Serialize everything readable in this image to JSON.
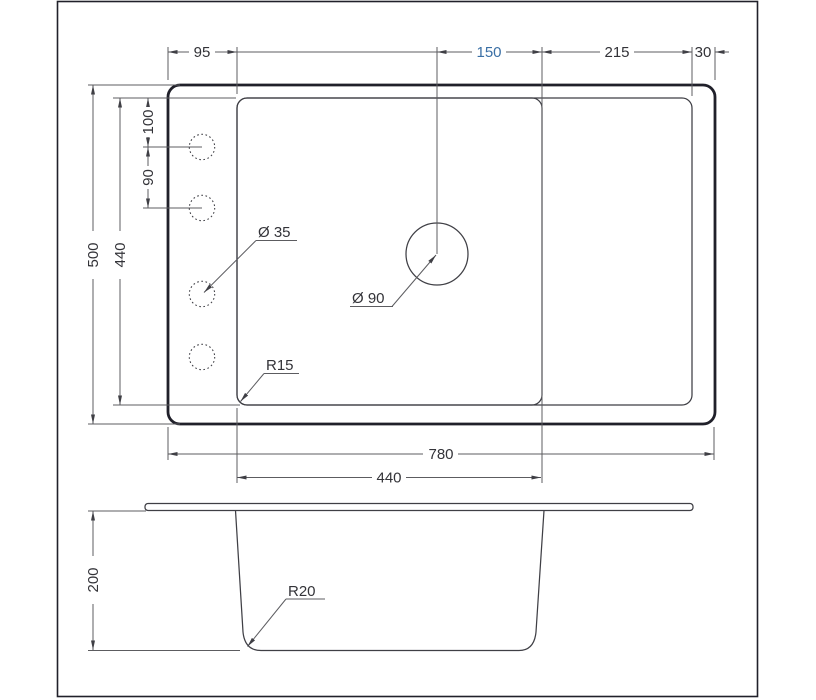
{
  "colors": {
    "background": "#ffffff",
    "line_dark": "#20202a",
    "line": "#3f3f45",
    "dim": "#5c5c60",
    "text": "#333338",
    "accent_blue": "#3a6fa5"
  },
  "dims": {
    "rim_to_bowl_left": "95",
    "drain_to_divider": "150",
    "drainboard_width": "215",
    "right_edge": "30",
    "hole_offset_top": "100",
    "hole_spacing": "90",
    "overall_height": "500",
    "inner_height": "440",
    "overall_width": "780",
    "bowl_width": "440",
    "bowl_depth": "200",
    "hole_diameter": "Ø 35",
    "drain_diameter": "Ø 90",
    "inner_corner_radius": "R15",
    "bottom_corner_radius": "R20"
  }
}
